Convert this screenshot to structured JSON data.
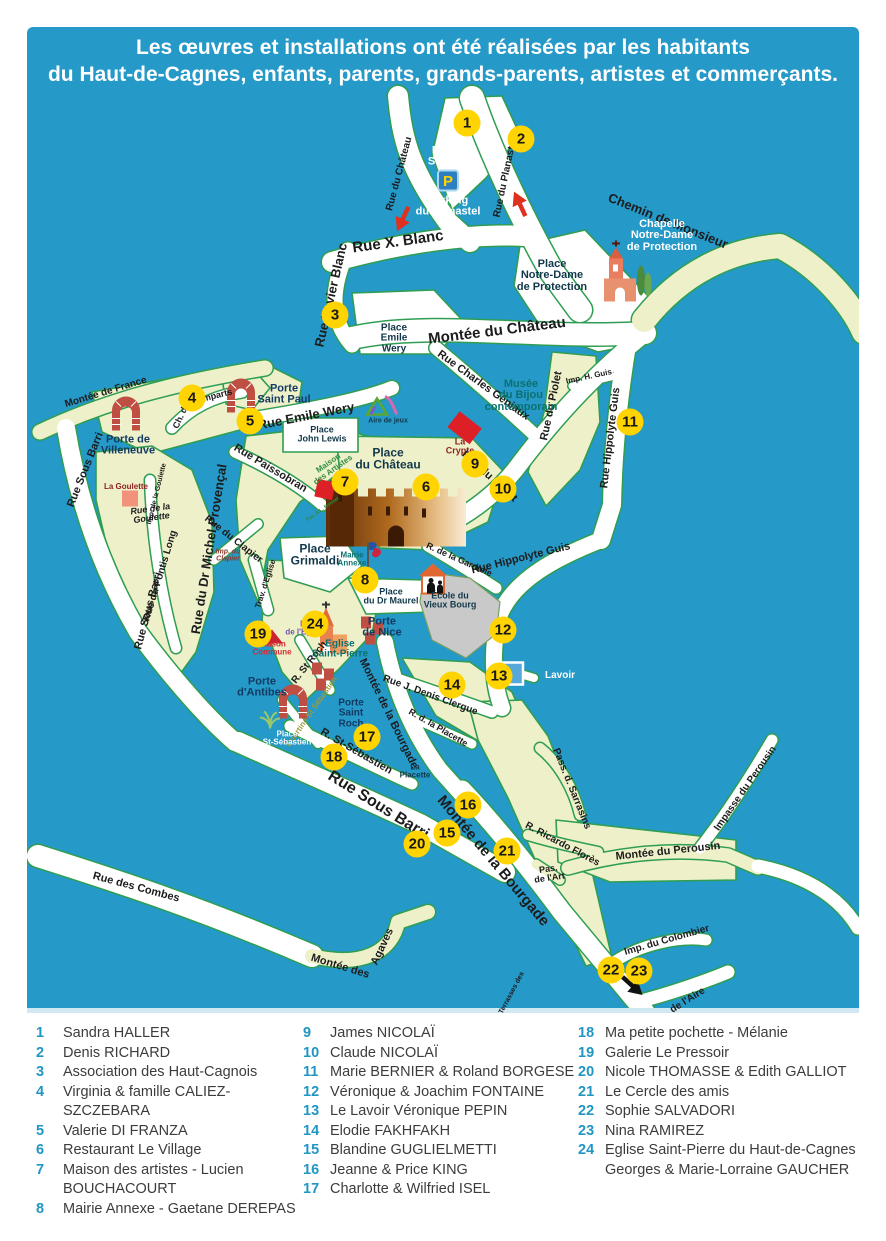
{
  "colors": {
    "map_bg": "#2599c8",
    "marker_fill": "#ffd400",
    "road_casing": "#2f9e52",
    "village_fill": "#eef0c9",
    "legend_number": "#2196c4"
  },
  "title": {
    "line1": "Les œuvres et installations ont été réalisées par les habitants",
    "line2": "du Haut-de-Cagnes, enfants, parents, grands-parents, artistes et commerçants."
  },
  "map": {
    "labels": [
      {
        "t": "Rue du Château",
        "x": 400,
        "y": 174,
        "r": -75,
        "s": 10
      },
      {
        "t": "Rue du Planastel",
        "x": 506,
        "y": 178,
        "r": -78,
        "s": 10
      },
      {
        "t": "Rue X. Blanc",
        "x": 398,
        "y": 242,
        "r": -8,
        "s": 15
      },
      {
        "t": "Chemin de Monsieur",
        "x": 668,
        "y": 221,
        "r": 22,
        "s": 13
      },
      {
        "t": "Rue Xavier Blanc",
        "x": 331,
        "y": 295,
        "r": -77,
        "s": 13
      },
      {
        "t": "Montée du Château",
        "x": 497,
        "y": 331,
        "r": -7,
        "s": 15
      },
      {
        "t": "Rue Charles Géniaux",
        "x": 483,
        "y": 386,
        "r": 36,
        "s": 11
      },
      {
        "t": "Imp. H. Guis",
        "x": 589,
        "y": 377,
        "r": -12,
        "s": 8
      },
      {
        "t": "Rue du Piolet",
        "x": 552,
        "y": 406,
        "r": -78,
        "s": 11
      },
      {
        "t": "Rue du Piolet",
        "x": 489,
        "y": 477,
        "r": 42,
        "s": 11
      },
      {
        "t": "Rue Hippolyte Guis",
        "x": 611,
        "y": 438,
        "r": -83,
        "s": 11
      },
      {
        "t": "Rue Hippolyte Guis",
        "x": 521,
        "y": 559,
        "r": -14,
        "s": 11
      },
      {
        "t": "R. de la Gardiole",
        "x": 459,
        "y": 560,
        "r": 24,
        "s": 9
      },
      {
        "t": "Montée de France",
        "x": 106,
        "y": 393,
        "r": -17,
        "s": 10
      },
      {
        "t": "Rue Sous Barri",
        "x": 86,
        "y": 470,
        "r": -68,
        "s": 11
      },
      {
        "t": "Rue Sous Barri",
        "x": 149,
        "y": 611,
        "r": -75,
        "s": 11
      },
      {
        "t": "Rue Sous Barri",
        "x": 378,
        "y": 806,
        "r": 32,
        "s": 16
      },
      {
        "t": "Rue Emile Wery",
        "x": 306,
        "y": 416,
        "r": -11,
        "s": 13
      },
      {
        "t": "Rue Paissobran",
        "x": 270,
        "y": 469,
        "r": 31,
        "s": 11
      },
      {
        "t": "Ch. d.",
        "x": 181,
        "y": 417,
        "r": -65,
        "s": 9
      },
      {
        "t": "Remparts",
        "x": 212,
        "y": 397,
        "r": -14,
        "s": 9
      },
      {
        "t": "Rue de la\nGoulette",
        "x": 151,
        "y": 514,
        "r": -8,
        "s": 9,
        "i": 1
      },
      {
        "t": "Imp. de la Goulette",
        "x": 157,
        "y": 494,
        "r": -76,
        "s": 7
      },
      {
        "t": "Rue du Pontis Long",
        "x": 161,
        "y": 576,
        "r": -73,
        "s": 10
      },
      {
        "t": "Rue du Dr Michel Provençal",
        "x": 209,
        "y": 549,
        "r": -81,
        "s": 13
      },
      {
        "t": "Rue du Clapier",
        "x": 233,
        "y": 540,
        "r": 38,
        "s": 10
      },
      {
        "t": "Imp. du\nClapier",
        "x": 228,
        "y": 556,
        "r": 0,
        "s": 7,
        "c": "brown",
        "i": 1
      },
      {
        "t": "Trav. d'Eglise",
        "x": 266,
        "y": 584,
        "r": -72,
        "s": 8
      },
      {
        "t": "R. St Roch",
        "x": 310,
        "y": 663,
        "r": -52,
        "s": 10
      },
      {
        "t": "Courtine St Sébastien",
        "x": 312,
        "y": 712,
        "r": -55,
        "s": 8,
        "c": "olive"
      },
      {
        "t": "R. St-Sébastien",
        "x": 356,
        "y": 752,
        "r": 30,
        "s": 11
      },
      {
        "t": "Montée de la Bourgade",
        "x": 388,
        "y": 714,
        "r": 64,
        "s": 11
      },
      {
        "t": "Montée de la Bourgade",
        "x": 493,
        "y": 861,
        "r": 50,
        "s": 15
      },
      {
        "t": "Rue J. Denis Clergue",
        "x": 430,
        "y": 696,
        "r": 20,
        "s": 10
      },
      {
        "t": "R. d. la Placette",
        "x": 438,
        "y": 728,
        "r": 30,
        "s": 9
      },
      {
        "t": "Pass. d. Sarrasins",
        "x": 571,
        "y": 789,
        "r": 68,
        "s": 10
      },
      {
        "t": "R. Ricardo Florès",
        "x": 562,
        "y": 845,
        "r": 28,
        "s": 10
      },
      {
        "t": "Pas.\nde l'Art",
        "x": 549,
        "y": 874,
        "r": -8,
        "s": 9
      },
      {
        "t": "Montée du Perousin",
        "x": 668,
        "y": 852,
        "r": -6,
        "s": 11
      },
      {
        "t": "Impasse du Perousin",
        "x": 746,
        "y": 789,
        "r": -55,
        "s": 10
      },
      {
        "t": "Imp. du Colombier",
        "x": 667,
        "y": 941,
        "r": -16,
        "s": 10
      },
      {
        "t": "Rue des Combes",
        "x": 136,
        "y": 888,
        "r": 15,
        "s": 11
      },
      {
        "t": "Montée des",
        "x": 340,
        "y": 967,
        "r": 17,
        "s": 11
      },
      {
        "t": "Agaves",
        "x": 383,
        "y": 947,
        "r": -65,
        "s": 11
      },
      {
        "t": "de l'Aire",
        "x": 688,
        "y": 1001,
        "r": -32,
        "s": 10
      },
      {
        "t": "Terrasses des",
        "x": 512,
        "y": 993,
        "r": -62,
        "s": 7
      },
      {
        "t": "Parking\nSte-Anne",
        "x": 452,
        "y": 157,
        "s": 11,
        "c": "wh"
      },
      {
        "t": "Parking\ndu Planastel",
        "x": 448,
        "y": 207,
        "s": 11,
        "c": "wh"
      },
      {
        "t": "Chapelle\nNotre-Dame\nde Protection",
        "x": 662,
        "y": 236,
        "s": 11,
        "c": "wh"
      },
      {
        "t": "Place\nNotre-Dame\nde Protection",
        "x": 552,
        "y": 276,
        "s": 11,
        "c": "pl"
      },
      {
        "t": "Place\nEmile\nWery",
        "x": 394,
        "y": 339,
        "s": 10,
        "c": "pl"
      },
      {
        "t": "Place\nJohn Lewis",
        "x": 322,
        "y": 435,
        "s": 9,
        "c": "pl"
      },
      {
        "t": "Aire de jeux",
        "x": 388,
        "y": 421,
        "s": 7,
        "c": "pl"
      },
      {
        "t": "Musée\ndu Bijou\ncontemporain",
        "x": 521,
        "y": 396,
        "s": 11,
        "c": "teal"
      },
      {
        "t": "La\nCrypte",
        "x": 460,
        "y": 447,
        "s": 9,
        "c": "darkred"
      },
      {
        "t": "Place\ndu Château",
        "x": 388,
        "y": 459,
        "s": 12,
        "b": 1,
        "c": "pl"
      },
      {
        "t": "Place\nGrimaldi",
        "x": 315,
        "y": 555,
        "s": 12,
        "b": 1,
        "c": "pl"
      },
      {
        "t": "Mairie\nAnnexe",
        "x": 352,
        "y": 560,
        "s": 8,
        "c": "teal"
      },
      {
        "t": "Place\ndu Dr Maurel",
        "x": 391,
        "y": 597,
        "s": 9,
        "c": "pl"
      },
      {
        "t": "École du\nVieux Bourg",
        "x": 450,
        "y": 601,
        "s": 9,
        "c": "pl"
      },
      {
        "t": "Porte\nSaint Paul",
        "x": 284,
        "y": 395,
        "s": 11,
        "c": "navy"
      },
      {
        "t": "Porte de\nVilleneuve",
        "x": 128,
        "y": 446,
        "s": 11,
        "c": "navy"
      },
      {
        "t": "La Goulette",
        "x": 126,
        "y": 487,
        "s": 8,
        "c": "darkred"
      },
      {
        "t": "Porte\nde Nice",
        "x": 382,
        "y": 628,
        "s": 11,
        "c": "navy"
      },
      {
        "t": "Eglise\nSaint-Pierre",
        "x": 340,
        "y": 650,
        "s": 10,
        "c": "teal"
      },
      {
        "t": "Maison\nCommune",
        "x": 272,
        "y": 649,
        "s": 8,
        "c": "red"
      },
      {
        "t": "Pl.\nde l'Eglise",
        "x": 305,
        "y": 629,
        "s": 8,
        "c": "purple"
      },
      {
        "t": "Porte\nd'Antibes",
        "x": 262,
        "y": 688,
        "s": 11,
        "c": "navy"
      },
      {
        "t": "Porte\nSaint\nRoch",
        "x": 351,
        "y": 714,
        "s": 10,
        "c": "navy"
      },
      {
        "t": "Place\nSt-Sébastien",
        "x": 287,
        "y": 739,
        "s": 8,
        "c": "wh"
      },
      {
        "t": "La\nPlacette",
        "x": 415,
        "y": 772,
        "s": 8,
        "c": "pl"
      },
      {
        "t": "Lavoir",
        "x": 560,
        "y": 676,
        "s": 10,
        "c": "wh"
      },
      {
        "t": "Maison\ndes Artistes",
        "x": 331,
        "y": 467,
        "r": -35,
        "s": 8,
        "c": "green"
      },
      {
        "t": "Pas. A.L. Bonnet",
        "x": 323,
        "y": 510,
        "r": -35,
        "s": 5,
        "c": "green"
      }
    ],
    "markers": [
      {
        "n": "1",
        "x": 467,
        "y": 123
      },
      {
        "n": "2",
        "x": 521,
        "y": 139
      },
      {
        "n": "3",
        "x": 335,
        "y": 315
      },
      {
        "n": "4",
        "x": 192,
        "y": 398
      },
      {
        "n": "5",
        "x": 250,
        "y": 421
      },
      {
        "n": "6",
        "x": 426,
        "y": 487
      },
      {
        "n": "7",
        "x": 345,
        "y": 482
      },
      {
        "n": "8",
        "x": 365,
        "y": 580
      },
      {
        "n": "9",
        "x": 475,
        "y": 464
      },
      {
        "n": "10",
        "x": 503,
        "y": 489
      },
      {
        "n": "11",
        "x": 630,
        "y": 422
      },
      {
        "n": "12",
        "x": 503,
        "y": 630
      },
      {
        "n": "13",
        "x": 499,
        "y": 676
      },
      {
        "n": "14",
        "x": 452,
        "y": 685
      },
      {
        "n": "15",
        "x": 447,
        "y": 833
      },
      {
        "n": "16",
        "x": 468,
        "y": 805
      },
      {
        "n": "17",
        "x": 367,
        "y": 737
      },
      {
        "n": "18",
        "x": 334,
        "y": 757
      },
      {
        "n": "19",
        "x": 258,
        "y": 634
      },
      {
        "n": "20",
        "x": 417,
        "y": 844
      },
      {
        "n": "21",
        "x": 507,
        "y": 851
      },
      {
        "n": "22",
        "x": 611,
        "y": 970
      },
      {
        "n": "23",
        "x": 639,
        "y": 971
      },
      {
        "n": "24",
        "x": 315,
        "y": 624
      }
    ],
    "icons": [
      {
        "k": "parking",
        "name": "parking-icon",
        "x": 448,
        "y": 183
      },
      {
        "k": "chapel",
        "name": "chapel-notre-dame-icon",
        "x": 627,
        "y": 274
      },
      {
        "k": "church",
        "name": "eglise-saint-pierre-icon",
        "x": 331,
        "y": 630
      },
      {
        "k": "castle",
        "name": "chateau-grimaldi-icon",
        "x": 396,
        "y": 511
      },
      {
        "k": "arch",
        "name": "porte-villeneuve-arch-icon",
        "x": 126,
        "y": 413
      },
      {
        "k": "arch",
        "name": "porte-saint-paul-arch-icon",
        "x": 241,
        "y": 395
      },
      {
        "k": "arch",
        "name": "porte-antibes-arch-icon",
        "x": 293,
        "y": 701
      },
      {
        "k": "bricks",
        "name": "porte-saint-roch-bricks-icon",
        "x": 323,
        "y": 680
      },
      {
        "k": "bricks",
        "name": "porte-de-nice-bricks-icon",
        "x": 372,
        "y": 634
      },
      {
        "k": "redsq",
        "name": "maison-artistes-marker",
        "x": 325,
        "y": 492
      },
      {
        "k": "crypt",
        "name": "la-crypte-marker",
        "x": 464,
        "y": 431
      },
      {
        "k": "salmon",
        "name": "la-goulette-marker",
        "x": 130,
        "y": 501
      },
      {
        "k": "wedge",
        "name": "maison-commune-marker",
        "x": 272,
        "y": 639
      },
      {
        "k": "flag",
        "name": "mairie-annexe-flag-icon",
        "x": 374,
        "y": 557
      },
      {
        "k": "lavoir",
        "name": "lavoir-marker",
        "x": 512,
        "y": 676
      },
      {
        "k": "school",
        "name": "ecole-vieux-bourg-icon",
        "x": 437,
        "y": 581
      },
      {
        "k": "play",
        "name": "playground-icon",
        "x": 382,
        "y": 407
      },
      {
        "k": "palm",
        "name": "palm-icon",
        "x": 270,
        "y": 722
      },
      {
        "k": "arrow",
        "name": "one-way-arrow-icon",
        "x": 403,
        "y": 221,
        "d": 115,
        "col": "#e03020"
      },
      {
        "k": "arrow",
        "name": "one-way-arrow-icon",
        "x": 520,
        "y": 207,
        "d": -115,
        "col": "#e03020"
      },
      {
        "k": "arrow",
        "name": "route-arrow-icon",
        "x": 632,
        "y": 988,
        "d": 42,
        "col": "#111111"
      }
    ]
  },
  "legend": {
    "columns": [
      [
        {
          "n": "1",
          "t": "Sandra HALLER"
        },
        {
          "n": "2",
          "t": "Denis RICHARD"
        },
        {
          "n": "3",
          "t": "Association des Haut-Cagnois"
        },
        {
          "n": "4",
          "t": "Virginia & famille CALIEZ-SZCZEBARA"
        },
        {
          "n": "5",
          "t": "Valerie DI FRANZA"
        },
        {
          "n": "6",
          "t": "Restaurant Le Village"
        },
        {
          "n": "7",
          "t": "Maison des artistes - Lucien BOUCHACOURT"
        },
        {
          "n": "8",
          "t": "Mairie Annexe - Gaetane DEREPAS"
        }
      ],
      [
        {
          "n": "9",
          "t": "James NICOLAÏ"
        },
        {
          "n": "10",
          "t": "Claude NICOLAÏ"
        },
        {
          "n": "11",
          "t": "Marie BERNIER & Roland BORGESE"
        },
        {
          "n": "12",
          "t": "Véronique & Joachim FONTAINE"
        },
        {
          "n": "13",
          "t": "Le Lavoir Véronique PEPIN"
        },
        {
          "n": "14",
          "t": "Elodie FAKHFAKH"
        },
        {
          "n": "15",
          "t": "Blandine GUGLIELMETTI"
        },
        {
          "n": "16",
          "t": "Jeanne & Price KING"
        },
        {
          "n": "17",
          "t": "Charlotte & Wilfried ISEL"
        }
      ],
      [
        {
          "n": "18",
          "t": "Ma petite pochette - Mélanie"
        },
        {
          "n": "19",
          "t": "Galerie Le Pressoir"
        },
        {
          "n": "20",
          "t": "Nicole THOMASSE & Edith GALLIOT"
        },
        {
          "n": "21",
          "t": "Le Cercle des amis"
        },
        {
          "n": "22",
          "t": "Sophie SALVADORI"
        },
        {
          "n": "23",
          "t": "Nina RAMIREZ"
        },
        {
          "n": "24",
          "t": "Eglise Saint-Pierre du Haut-de-Cagnes Georges & Marie-Lorraine GAUCHER"
        }
      ]
    ]
  }
}
